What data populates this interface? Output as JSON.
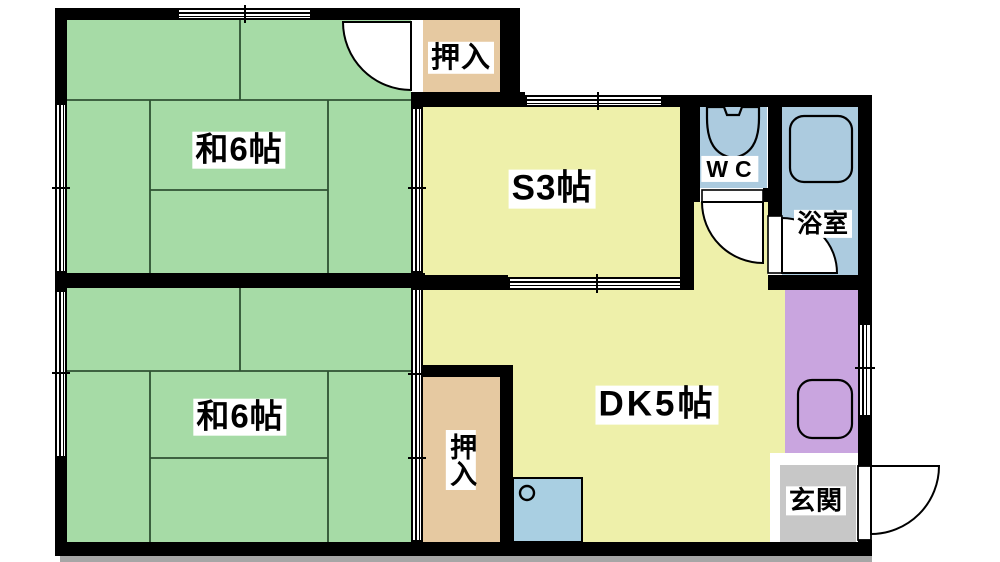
{
  "plan": {
    "type": "apartment-floor-plan",
    "rooms": [
      {
        "id": "washitsu-upper",
        "label": "和6帖",
        "color": "#a6dba6"
      },
      {
        "id": "washitsu-lower",
        "label": "和6帖",
        "color": "#a6dba6"
      },
      {
        "id": "service-room",
        "label": "S3帖",
        "color": "#eef0aa"
      },
      {
        "id": "dining-kitchen",
        "label": "DK5帖",
        "color": "#eef0aa"
      },
      {
        "id": "closet-upper",
        "label": "押入",
        "color": "#e6c9a1"
      },
      {
        "id": "closet-lower",
        "label": "押入",
        "color": "#e6c9a1"
      },
      {
        "id": "toilet",
        "label": "WC",
        "color": "#accbdf"
      },
      {
        "id": "bathroom",
        "label": "浴室",
        "color": "#accbdf"
      },
      {
        "id": "entrance",
        "label": "玄関",
        "color": "#c7c7c7"
      },
      {
        "id": "utility-alcove",
        "label": "",
        "color": "#c9a5df"
      }
    ],
    "fixtures": [
      {
        "name": "toilet-icon"
      },
      {
        "name": "bathtub-icon"
      },
      {
        "name": "washing-machine-pan-icon"
      },
      {
        "name": "kitchen-sink-icon"
      }
    ],
    "doors": [
      {
        "name": "upper-room-closet-door"
      },
      {
        "name": "wc-door"
      },
      {
        "name": "bathroom-door"
      },
      {
        "name": "entrance-door"
      }
    ],
    "windows": [
      {
        "name": "upper-room-north-window"
      },
      {
        "name": "upper-room-west-window"
      },
      {
        "name": "lower-room-west-window"
      },
      {
        "name": "service-room-north-window"
      },
      {
        "name": "utility-east-window"
      }
    ],
    "sliding_doors": [
      {
        "name": "upper-room-service-partition"
      },
      {
        "name": "lower-room-dk-closet-partition"
      },
      {
        "name": "service-dk-partition"
      }
    ],
    "colors": {
      "wall": "#000000",
      "tatami_line": "#2f5233",
      "window_fill": "#ffffff",
      "shadow": "#a6a6a6",
      "sink_fill": "#a9cfe2",
      "background": "#ffffff"
    }
  }
}
